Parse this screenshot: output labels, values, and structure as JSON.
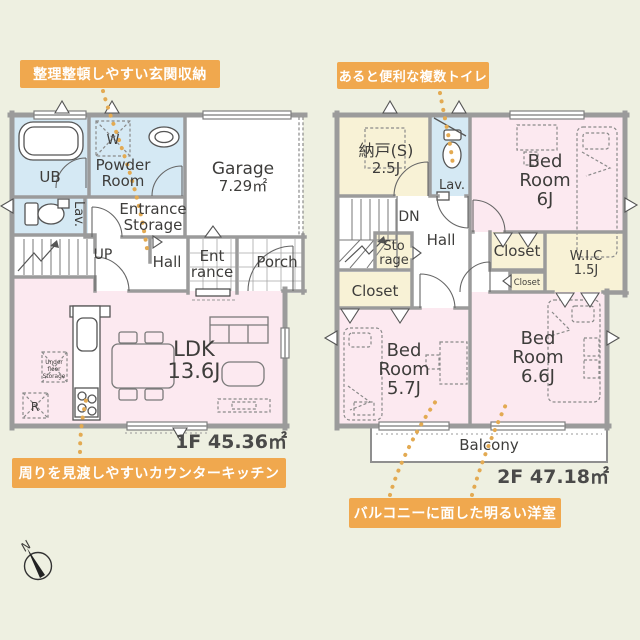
{
  "callouts": {
    "entrance_storage": "整理整頓しやすい玄関収納",
    "multiple_toilets": "あると便利な複数トイレ",
    "counter_kitchen": "周りを見渡しやすいカウンターキッチン",
    "bright_rooms": "バルコニーに面した明るい洋室"
  },
  "floor1": {
    "area": "1F 45.36㎡",
    "ub": "UB",
    "washer": "W",
    "powder1": "Powder",
    "powder2": "Room",
    "lav": "Lav.",
    "storage1": "Entrance",
    "storage2": "Storage",
    "garage": "Garage",
    "garage_area": "7.29㎡",
    "up": "UP",
    "hall": "Hall",
    "entrance1": "Ent",
    "entrance2": "rance",
    "porch": "Porch",
    "ldk": "LDK",
    "ldk_size": "13.6J",
    "underfloor1": "Under",
    "underfloor2": "floor",
    "underfloor3": "Storage",
    "fridge": "R"
  },
  "floor2": {
    "area": "2F 47.18㎡",
    "storeroom1": "納戸(S)",
    "storeroom2": "2.5J",
    "lav": "Lav.",
    "bed6_1": "Bed",
    "bed6_2": "Room",
    "bed6_3": "6J",
    "dn": "DN",
    "hall": "Hall",
    "sto1": "Sto",
    "sto2": "rage",
    "closet_left": "Closet",
    "closet_mid": "Closet",
    "closet_small": "Closet",
    "wic1": "W.I.C",
    "wic2": "1.5J",
    "bed57_1": "Bed",
    "bed57_2": "Room",
    "bed57_3": "5.7J",
    "bed66_1": "Bed",
    "bed66_2": "Room",
    "bed66_3": "6.6J",
    "balcony": "Balcony"
  },
  "compass": {
    "north": "N"
  },
  "colors": {
    "background": "#eef0e1",
    "callout_orange": "#f0a84e",
    "leader_dots": "#e3aa52",
    "wall_gray": "#9b9b9b",
    "room_pink": "#fce9f0",
    "room_blue": "#d5e9f4",
    "room_yellow": "#f8f2d6",
    "label_text": "#3e3d3b"
  }
}
